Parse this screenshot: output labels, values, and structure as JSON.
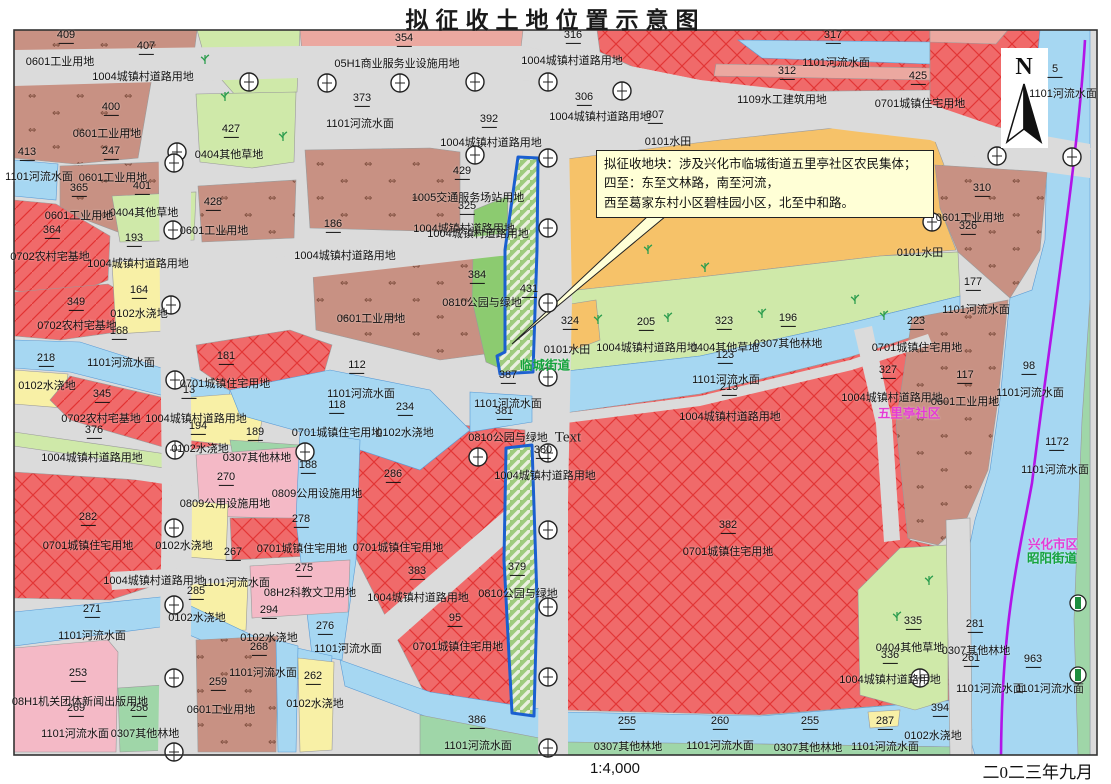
{
  "title": "拟征收土地位置示意图",
  "footer": {
    "scale": "1:4,000",
    "date": "二0二三年九月"
  },
  "north_label": "N",
  "annotation": {
    "line1": "拟征收地块：涉及兴化市临城街道五里亭社区农民集体；",
    "line2": "四至：东至文林路，南至河流，",
    "line3": "西至葛家东村小区碧桂园小区，北至中和路。"
  },
  "palette": {
    "road": "#DBDBDB",
    "water": "#A6D7F2",
    "grass": "#CFE9A9",
    "forest": "#9FD6A8",
    "park": "#8CCB70",
    "irrigated_yellow": "#F8F0A6",
    "paddy_orange": "#F6C269",
    "commercial_salmon": "#EBA8A0",
    "facility_pink": "#F4B9C6",
    "industrial_brown": "#C89183",
    "residential_red": "#F06A6A",
    "acquisition_outline_blue": "#1A5FD0",
    "boundary_purple": "#B114E8",
    "street_green_text": "#14A33C",
    "district_magenta_text": "#E53BD6"
  },
  "map": {
    "labels": [
      [
        "409",
        66,
        37,
        "n"
      ],
      [
        "407",
        146,
        48,
        "n"
      ],
      [
        "354",
        404,
        40,
        "n"
      ],
      [
        "316",
        573,
        37,
        "n"
      ],
      [
        "317",
        833,
        37,
        "n"
      ],
      [
        "312",
        787,
        73,
        "n"
      ],
      [
        "425",
        918,
        78,
        "n"
      ],
      [
        "5",
        1055,
        71,
        "n"
      ],
      [
        "400",
        111,
        109,
        "n"
      ],
      [
        "373",
        362,
        100,
        "n"
      ],
      [
        "306",
        584,
        99,
        "n"
      ],
      [
        "392",
        489,
        121,
        "n"
      ],
      [
        "307",
        655,
        117,
        "n"
      ],
      [
        "427",
        231,
        131,
        "n"
      ],
      [
        "247",
        111,
        153,
        "n"
      ],
      [
        "413",
        27,
        154,
        "n"
      ],
      [
        "429",
        462,
        173,
        "n"
      ],
      [
        "365",
        79,
        190,
        "n"
      ],
      [
        "401",
        142,
        188,
        "n"
      ],
      [
        "325",
        467,
        208,
        "n"
      ],
      [
        "428",
        213,
        204,
        "n"
      ],
      [
        "310",
        982,
        190,
        "n"
      ],
      [
        "326",
        968,
        228,
        "n"
      ],
      [
        "186",
        333,
        226,
        "n"
      ],
      [
        "364",
        52,
        232,
        "n"
      ],
      [
        "193",
        134,
        240,
        "n"
      ],
      [
        "177",
        973,
        284,
        "n"
      ],
      [
        "384",
        477,
        277,
        "n"
      ],
      [
        "431",
        529,
        291,
        "n"
      ],
      [
        "164",
        139,
        292,
        "n"
      ],
      [
        "349",
        76,
        304,
        "n"
      ],
      [
        "324",
        570,
        323,
        "n"
      ],
      [
        "223",
        916,
        323,
        "n"
      ],
      [
        "205",
        646,
        324,
        "n"
      ],
      [
        "323",
        724,
        323,
        "n"
      ],
      [
        "196",
        788,
        320,
        "n"
      ],
      [
        "168",
        119,
        333,
        "n"
      ],
      [
        "123",
        725,
        357,
        "n"
      ],
      [
        "112",
        357,
        367,
        "n"
      ],
      [
        "181",
        226,
        358,
        "n"
      ],
      [
        "218",
        46,
        360,
        "n"
      ],
      [
        "98",
        1029,
        368,
        "n"
      ],
      [
        "117",
        965,
        377,
        "n"
      ],
      [
        "327",
        888,
        372,
        "n"
      ],
      [
        "387",
        508,
        377,
        "n"
      ],
      [
        "13",
        189,
        392,
        "n"
      ],
      [
        "213",
        729,
        389,
        "n"
      ],
      [
        "345",
        102,
        396,
        "n"
      ],
      [
        "118",
        337,
        407,
        "n"
      ],
      [
        "234",
        405,
        409,
        "n"
      ],
      [
        "381",
        504,
        413,
        "n"
      ],
      [
        "376",
        94,
        432,
        "n"
      ],
      [
        "194",
        198,
        428,
        "n"
      ],
      [
        "189",
        255,
        434,
        "n"
      ],
      [
        "1172",
        1057,
        444,
        "n"
      ],
      [
        "380",
        543,
        452,
        "n"
      ],
      [
        "188",
        308,
        467,
        "n"
      ],
      [
        "270",
        226,
        479,
        "n"
      ],
      [
        "286",
        393,
        476,
        "n"
      ],
      [
        "282",
        88,
        519,
        "n"
      ],
      [
        "278",
        301,
        521,
        "n"
      ],
      [
        "382",
        728,
        527,
        "n"
      ],
      [
        "267",
        233,
        554,
        "n"
      ],
      [
        "275",
        304,
        570,
        "n"
      ],
      [
        "379",
        517,
        569,
        "n"
      ],
      [
        "383",
        417,
        573,
        "n"
      ],
      [
        "285",
        196,
        593,
        "n"
      ],
      [
        "271",
        92,
        611,
        "n"
      ],
      [
        "294",
        269,
        612,
        "n"
      ],
      [
        "95",
        455,
        620,
        "n"
      ],
      [
        "335",
        913,
        623,
        "n"
      ],
      [
        "281",
        975,
        626,
        "n"
      ],
      [
        "276",
        325,
        628,
        "n"
      ],
      [
        "268",
        259,
        649,
        "n"
      ],
      [
        "336",
        890,
        657,
        "n"
      ],
      [
        "261",
        971,
        660,
        "n"
      ],
      [
        "963",
        1033,
        661,
        "n"
      ],
      [
        "253",
        78,
        675,
        "n"
      ],
      [
        "262",
        313,
        678,
        "n"
      ],
      [
        "259",
        218,
        684,
        "n"
      ],
      [
        "269",
        76,
        710,
        "n"
      ],
      [
        "256",
        139,
        710,
        "n"
      ],
      [
        "394",
        940,
        710,
        "n"
      ],
      [
        "386",
        477,
        722,
        "n"
      ],
      [
        "255",
        627,
        723,
        "n"
      ],
      [
        "260",
        720,
        723,
        "n"
      ],
      [
        "255",
        810,
        723,
        "n"
      ],
      [
        "287",
        885,
        723,
        "n"
      ],
      [
        "0601工业用地",
        60,
        61,
        "c"
      ],
      [
        "1004城镇村道路用地",
        143,
        76,
        "c"
      ],
      [
        "05H1商业服务业设施用地",
        397,
        63,
        "c"
      ],
      [
        "1004城镇村道路用地",
        572,
        60,
        "c"
      ],
      [
        "1101河流水面",
        836,
        62,
        "c"
      ],
      [
        "0701城镇住宅用地",
        920,
        103,
        "c"
      ],
      [
        "1109水工建筑用地",
        782,
        99,
        "c"
      ],
      [
        "1101河流水面",
        1063,
        93,
        "c"
      ],
      [
        "0601工业用地",
        107,
        133,
        "c"
      ],
      [
        "1101河流水面",
        360,
        123,
        "c"
      ],
      [
        "1004城镇村道路用地",
        600,
        116,
        "c"
      ],
      [
        "0101水田",
        668,
        141,
        "c"
      ],
      [
        "1004城镇村道路用地",
        491,
        142,
        "c"
      ],
      [
        "0404其他草地",
        229,
        154,
        "c"
      ],
      [
        "1101河流水面",
        39,
        176,
        "c"
      ],
      [
        "0601工业用地",
        113,
        177,
        "c"
      ],
      [
        "1005交通服务场站用地",
        468,
        197,
        "c"
      ],
      [
        "0404其他草地",
        144,
        212,
        "c"
      ],
      [
        "0601工业用地",
        79,
        215,
        "c"
      ],
      [
        "0601工业用地",
        214,
        230,
        "c"
      ],
      [
        "0601工业用地",
        970,
        217,
        "c"
      ],
      [
        "1004城镇村道路用地",
        464,
        228,
        "c"
      ],
      [
        "1004城镇村道路用地",
        345,
        255,
        "c"
      ],
      [
        "0702农村宅基地",
        50,
        256,
        "c"
      ],
      [
        "1004城镇村道路用地",
        138,
        263,
        "c"
      ],
      [
        "0101水田",
        920,
        252,
        "c"
      ],
      [
        "0102水浇地",
        139,
        313,
        "c"
      ],
      [
        "0601工业用地",
        371,
        318,
        "c"
      ],
      [
        "0702农村宅基地",
        77,
        325,
        "c"
      ],
      [
        "0810公园与绿地",
        482,
        302,
        "c"
      ],
      [
        "1004城镇村道路用地",
        478,
        233,
        "c"
      ],
      [
        "1101河流水面",
        976,
        309,
        "c"
      ],
      [
        "0701城镇住宅用地",
        917,
        347,
        "c"
      ],
      [
        "0101水田",
        567,
        349,
        "c"
      ],
      [
        "1004城镇村道路用地",
        647,
        347,
        "c"
      ],
      [
        "0404其他草地",
        725,
        347,
        "c"
      ],
      [
        "0307其他林地",
        788,
        343,
        "c"
      ],
      [
        "1101河流水面",
        726,
        379,
        "c"
      ],
      [
        "1101河流水面",
        1030,
        392,
        "c"
      ],
      [
        "1004城镇村道路用地",
        730,
        416,
        "c"
      ],
      [
        "0601工业用地",
        965,
        401,
        "c"
      ],
      [
        "1004城镇村道路用地",
        892,
        397,
        "c"
      ],
      [
        "0102水浇地",
        47,
        385,
        "c"
      ],
      [
        "1101河流水面",
        121,
        362,
        "c"
      ],
      [
        "0702农村宅基地",
        101,
        418,
        "c"
      ],
      [
        "1004城镇村道路用地",
        196,
        418,
        "c"
      ],
      [
        "0701城镇住宅用地",
        225,
        383,
        "c"
      ],
      [
        "1101河流水面",
        361,
        393,
        "c"
      ],
      [
        "1101河流水面",
        508,
        403,
        "c"
      ],
      [
        "0701城镇住宅用地",
        337,
        432,
        "c"
      ],
      [
        "0102水浇地",
        405,
        432,
        "c"
      ],
      [
        "0810公园与绿地",
        508,
        437,
        "c"
      ],
      [
        "1004城镇村道路用地",
        545,
        475,
        "c"
      ],
      [
        "0307其他林地",
        257,
        457,
        "c"
      ],
      [
        "0102水浇地",
        200,
        448,
        "c"
      ],
      [
        "1004城镇村道路用地",
        92,
        457,
        "c"
      ],
      [
        "0809公用设施用地",
        317,
        493,
        "c"
      ],
      [
        "0809公用设施用地",
        225,
        503,
        "c"
      ],
      [
        "0701城镇住宅用地",
        88,
        545,
        "c"
      ],
      [
        "0102水浇地",
        184,
        545,
        "c"
      ],
      [
        "0701城镇住宅用地",
        302,
        548,
        "c"
      ],
      [
        "0701城镇住宅用地",
        398,
        547,
        "c"
      ],
      [
        "1101河流水面",
        1055,
        469,
        "c"
      ],
      [
        "1004城镇村道路用地",
        154,
        580,
        "c"
      ],
      [
        "1101河流水面",
        236,
        582,
        "c"
      ],
      [
        "08H2科教文卫用地",
        310,
        592,
        "c"
      ],
      [
        "0102水浇地",
        197,
        617,
        "c"
      ],
      [
        "1101河流水面",
        92,
        635,
        "c"
      ],
      [
        "0102水浇地",
        269,
        637,
        "c"
      ],
      [
        "1101河流水面",
        263,
        672,
        "c"
      ],
      [
        "1101河流水面",
        348,
        648,
        "c"
      ],
      [
        "0601工业用地",
        221,
        709,
        "c"
      ],
      [
        "08H1机关团体新闻出版用地",
        80,
        701,
        "c"
      ],
      [
        "1101河流水面",
        75,
        733,
        "c"
      ],
      [
        "0307其他林地",
        145,
        733,
        "c"
      ],
      [
        "0102水浇地",
        315,
        703,
        "c"
      ],
      [
        "1004城镇村道路用地",
        418,
        597,
        "c"
      ],
      [
        "0701城镇住宅用地",
        458,
        646,
        "c"
      ],
      [
        "0810公园与绿地",
        518,
        593,
        "c"
      ],
      [
        "0701城镇住宅用地",
        728,
        551,
        "c"
      ],
      [
        "1101河流水面",
        478,
        745,
        "c"
      ],
      [
        "0404其他草地",
        910,
        647,
        "c"
      ],
      [
        "1004城镇村道路用地",
        890,
        679,
        "c"
      ],
      [
        "0307其他林地",
        976,
        650,
        "c"
      ],
      [
        "0307其他林地",
        628,
        746,
        "c"
      ],
      [
        "1101河流水面",
        720,
        745,
        "c"
      ],
      [
        "0307其他林地",
        808,
        747,
        "c"
      ],
      [
        "1101河流水面",
        885,
        746,
        "c"
      ],
      [
        "1101河流水面",
        990,
        688,
        "c"
      ],
      [
        "1101河流水面",
        1050,
        688,
        "c"
      ],
      [
        "0102水浇地",
        933,
        735,
        "c"
      ],
      [
        "临城街道",
        545,
        364,
        "g"
      ],
      [
        "昭阳街道",
        1052,
        557,
        "g"
      ],
      [
        "兴化市区",
        1053,
        543,
        "m"
      ],
      [
        "五里亭社区",
        909,
        412,
        "m"
      ],
      [
        "Text",
        568,
        438,
        "t"
      ]
    ],
    "symbols": {
      "clocks": [
        [
          249,
          82
        ],
        [
          327,
          83
        ],
        [
          400,
          83
        ],
        [
          475,
          82
        ],
        [
          548,
          82
        ],
        [
          622,
          91
        ],
        [
          177,
          152
        ],
        [
          475,
          155
        ],
        [
          548,
          158
        ],
        [
          997,
          156
        ],
        [
          1072,
          157
        ],
        [
          932,
          222
        ],
        [
          548,
          228
        ],
        [
          548,
          303
        ],
        [
          548,
          377
        ],
        [
          548,
          453
        ],
        [
          548,
          530
        ],
        [
          548,
          607
        ],
        [
          548,
          677
        ],
        [
          548,
          748
        ],
        [
          174,
          163
        ],
        [
          173,
          230
        ],
        [
          171,
          305
        ],
        [
          175,
          380
        ],
        [
          175,
          450
        ],
        [
          174,
          528
        ],
        [
          174,
          605
        ],
        [
          174,
          678
        ],
        [
          174,
          752
        ],
        [
          478,
          457
        ],
        [
          305,
          452
        ],
        [
          920,
          678
        ]
      ],
      "trees": [
        [
          205,
          60
        ],
        [
          225,
          97
        ],
        [
          283,
          137
        ],
        [
          598,
          320
        ],
        [
          668,
          318
        ],
        [
          762,
          314
        ],
        [
          884,
          316
        ],
        [
          705,
          268
        ],
        [
          648,
          250
        ],
        [
          855,
          300
        ],
        [
          929,
          581
        ],
        [
          897,
          617
        ]
      ],
      "wells": [
        [
          1078,
          603
        ],
        [
          1078,
          675
        ]
      ]
    }
  }
}
